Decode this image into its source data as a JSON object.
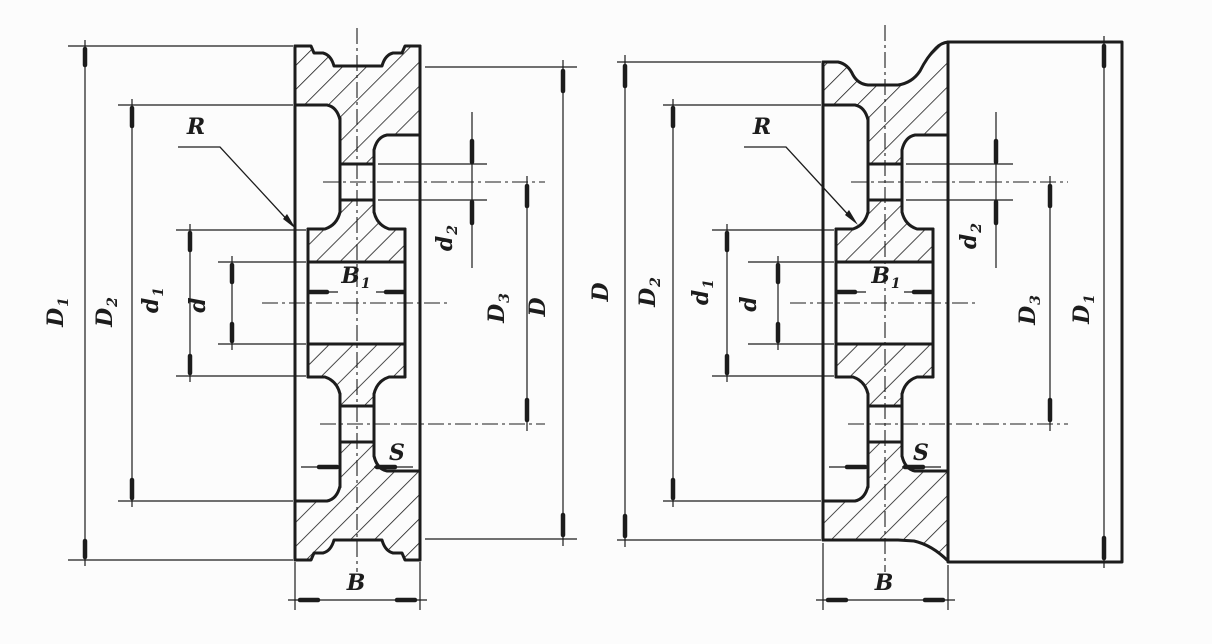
{
  "colors": {
    "ink": "#1c1c1c",
    "paper": "#fcfcfc"
  },
  "figures": {
    "left": {
      "labels": [
        {
          "base": "D",
          "sub": "1"
        },
        {
          "base": "D",
          "sub": "2"
        },
        {
          "base": "d",
          "sub": "1"
        },
        {
          "base": "d",
          "sub": ""
        },
        {
          "base": "R",
          "sub": ""
        },
        {
          "base": "B",
          "sub": "1"
        },
        {
          "base": "d",
          "sub": "2"
        },
        {
          "base": "D",
          "sub": "3"
        },
        {
          "base": "D",
          "sub": ""
        },
        {
          "base": "S",
          "sub": ""
        },
        {
          "base": "B",
          "sub": ""
        }
      ]
    },
    "right": {
      "labels": [
        {
          "base": "D",
          "sub": ""
        },
        {
          "base": "D",
          "sub": "2"
        },
        {
          "base": "d",
          "sub": "1"
        },
        {
          "base": "d",
          "sub": ""
        },
        {
          "base": "R",
          "sub": ""
        },
        {
          "base": "B",
          "sub": "1"
        },
        {
          "base": "d",
          "sub": "2"
        },
        {
          "base": "D",
          "sub": "3"
        },
        {
          "base": "D",
          "sub": "1"
        },
        {
          "base": "S",
          "sub": ""
        },
        {
          "base": "B",
          "sub": ""
        }
      ]
    }
  }
}
